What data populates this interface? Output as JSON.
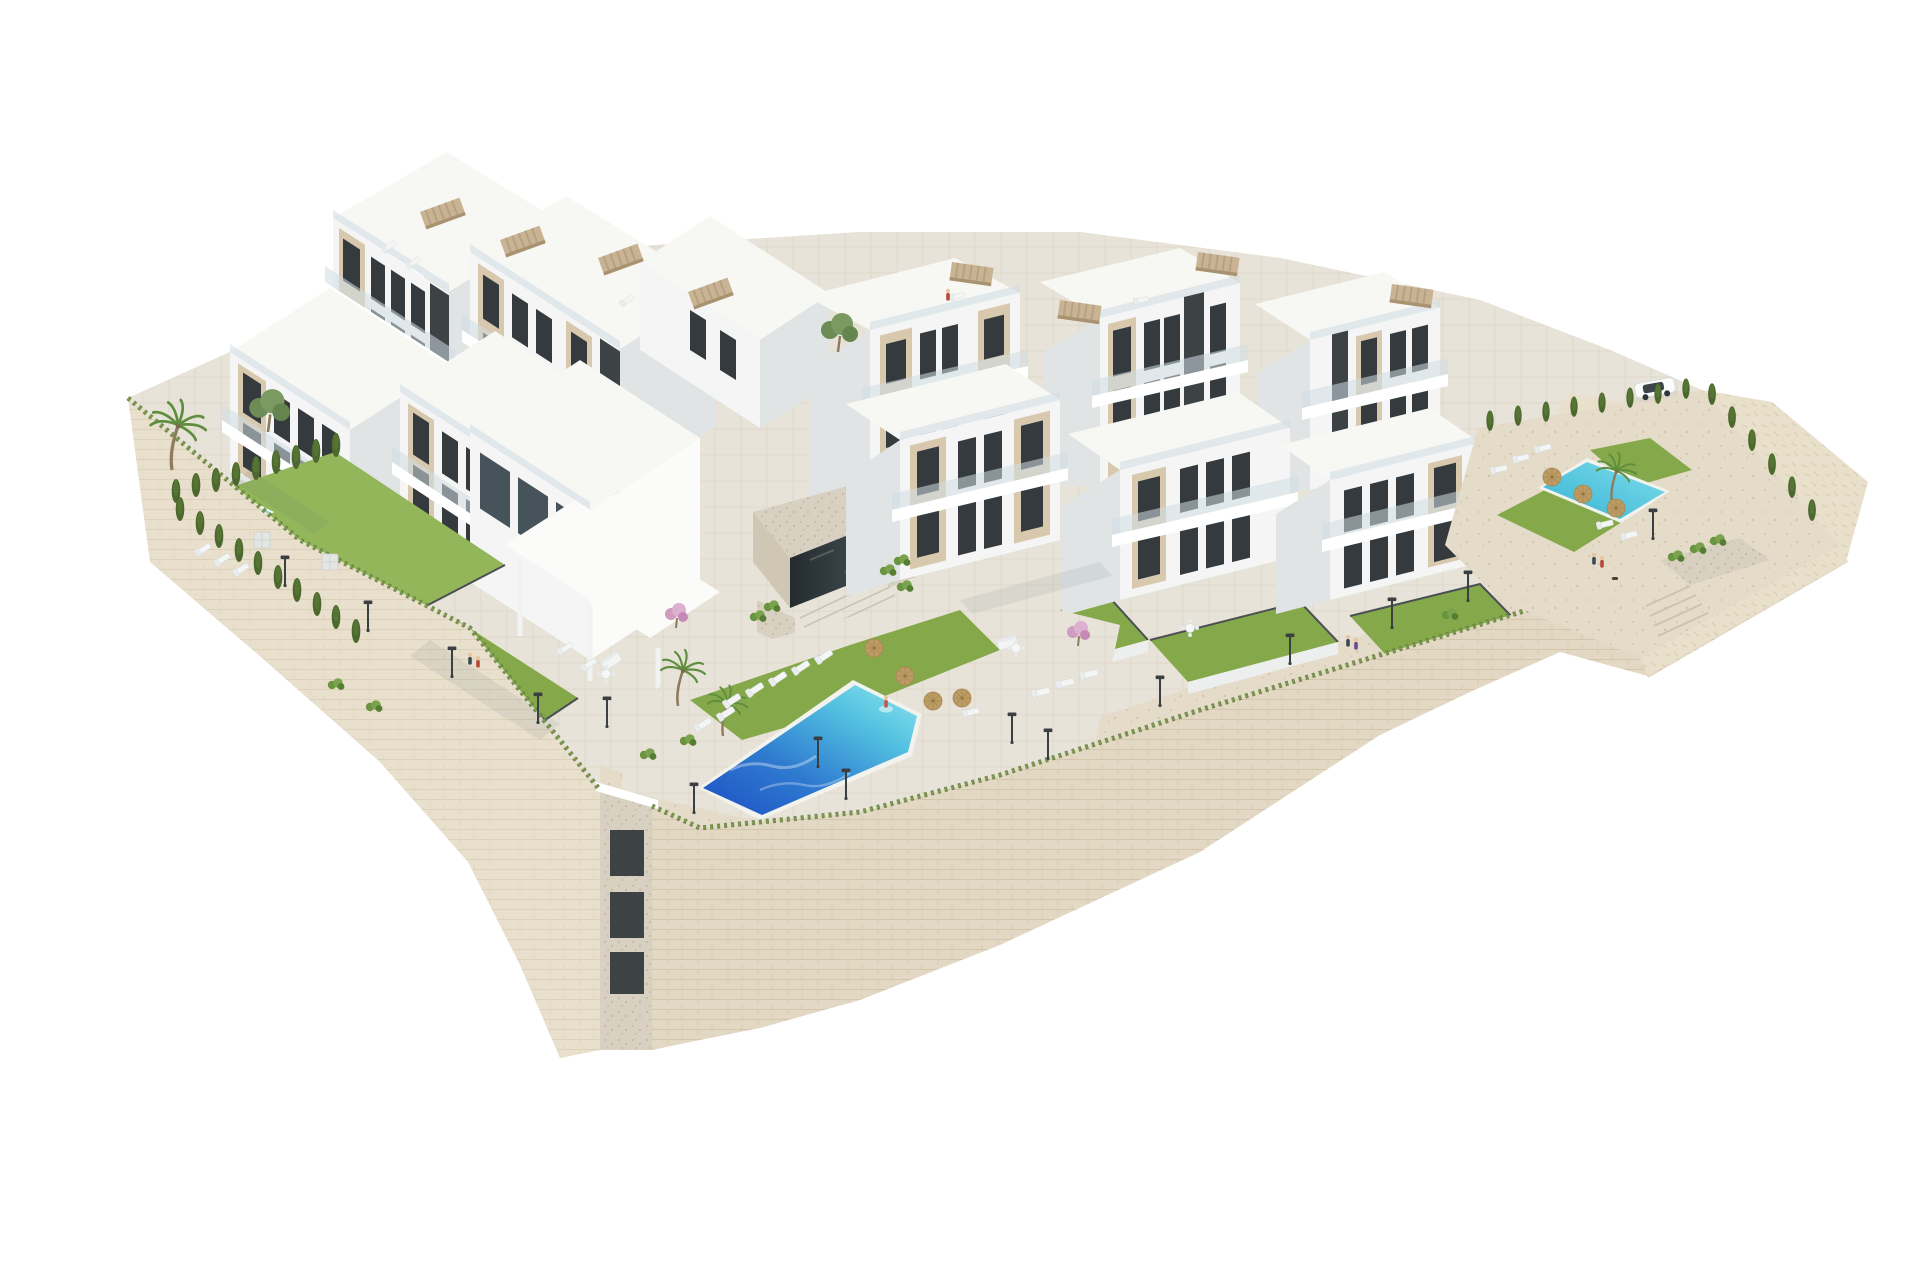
{
  "meta": {
    "title": "Aerial 3D architectural rendering of a hillside residential complex",
    "alt": "Photorealistic aerial render on a white background: terraced white and beige modern apartment blocks with rooftop pergolas and glass balconies, private lawned gardens, a large turquoise communal swimming pool with sun loungers and straw umbrellas, a smaller private pool on the left and another pool terrace with a parked white car on the right, all sitting on a curved sand-coloured stone retaining wall with street lamps, cypress hedges and palm trees."
  },
  "palette": {
    "background": "#ffffff",
    "facade_white": "#f4f5f4",
    "facade_bright": "#fbfbfa",
    "facade_side": "#e0e4e5",
    "facade_shade": "#ccd2d4",
    "roof_light": "#f7f7f3",
    "accent_beige": "#d8c9ae",
    "accent_beige_side": "#c2b093",
    "dark_tower": "#3d4245",
    "window_dark": "#343a3d",
    "glass_rail": "#cfdde3",
    "lawn": "#85a94a",
    "lawn_light": "#93b65a",
    "hedge": "#4c682e",
    "stone_wall": "#e2d8c3",
    "stone_joint": "#c9bb9e",
    "paving": "#e8e3d8",
    "paving_warm": "#e4dbc9",
    "pebble": "#d8d1c1",
    "rock": "#e9e0cc",
    "pool_deep": "#1e50c5",
    "pool_light": "#8ee6ef",
    "pool_small_a": "#35b2d4",
    "pool_small_b": "#7fdeea",
    "umbrella_straw": "#bb9c64",
    "lamp_dark": "#3a3f41",
    "fence": "#4a5053",
    "car_body": "#fafbfb",
    "trunk": "#8d7b5e",
    "palm_green": "#5f8f3e",
    "pink_tree": "#cf9cc0"
  },
  "scene": {
    "lamps": [
      [
        285,
        585
      ],
      [
        368,
        630
      ],
      [
        452,
        676
      ],
      [
        538,
        722
      ],
      [
        607,
        726
      ],
      [
        694,
        812
      ],
      [
        818,
        766
      ],
      [
        846,
        798
      ],
      [
        1012,
        742
      ],
      [
        1048,
        758
      ],
      [
        1160,
        705
      ],
      [
        1290,
        663
      ],
      [
        1392,
        627
      ],
      [
        1468,
        600
      ],
      [
        1653,
        538
      ]
    ],
    "cypresses": [
      [
        176,
        502
      ],
      [
        196,
        496
      ],
      [
        216,
        491
      ],
      [
        236,
        485
      ],
      [
        256,
        479
      ],
      [
        276,
        473
      ],
      [
        296,
        468
      ],
      [
        316,
        462
      ],
      [
        336,
        456
      ],
      [
        180,
        520
      ],
      [
        200,
        534
      ],
      [
        219,
        547
      ],
      [
        239,
        561
      ],
      [
        258,
        574
      ],
      [
        278,
        588
      ],
      [
        297,
        601
      ],
      [
        317,
        615
      ],
      [
        336,
        628
      ],
      [
        356,
        642
      ],
      [
        1490,
        430,
        0,
        0.85
      ],
      [
        1518,
        425,
        0,
        0.85
      ],
      [
        1546,
        421,
        0,
        0.85
      ],
      [
        1574,
        416,
        0,
        0.85
      ],
      [
        1602,
        412,
        0,
        0.85
      ],
      [
        1630,
        407,
        0,
        0.85
      ],
      [
        1658,
        403,
        0,
        0.85
      ],
      [
        1686,
        398,
        0,
        0.85
      ],
      [
        1712,
        404,
        0,
        0.9
      ],
      [
        1732,
        427,
        0,
        0.9
      ],
      [
        1752,
        450,
        0,
        0.9
      ],
      [
        1772,
        474,
        0,
        0.9
      ],
      [
        1792,
        497,
        0,
        0.9
      ],
      [
        1812,
        520,
        0,
        0.9
      ]
    ],
    "palms": [
      [
        172,
        470,
        0,
        1.25
      ],
      [
        678,
        706,
        0,
        1
      ],
      [
        723,
        736,
        0,
        0.9
      ],
      [
        1612,
        503,
        0,
        0.9
      ]
    ],
    "trees": [
      [
        268,
        432,
        0,
        1.1
      ],
      [
        838,
        352,
        0,
        1
      ]
    ],
    "pink_trees": [
      [
        676,
        628,
        0,
        1
      ],
      [
        1078,
        646,
        0,
        1
      ]
    ],
    "shrubs": [
      [
        758,
        620
      ],
      [
        772,
        610
      ],
      [
        888,
        574
      ],
      [
        902,
        564
      ],
      [
        688,
        744
      ],
      [
        648,
        758
      ],
      [
        1676,
        560
      ],
      [
        1698,
        552
      ],
      [
        1718,
        544
      ],
      [
        336,
        688
      ],
      [
        374,
        710
      ],
      [
        1450,
        618
      ],
      [
        905,
        590
      ]
    ],
    "loungers": [
      [
        733,
        700,
        -33
      ],
      [
        756,
        689,
        -33
      ],
      [
        779,
        678,
        -33
      ],
      [
        802,
        667,
        -33
      ],
      [
        825,
        656,
        -33
      ],
      [
        704,
        724,
        -33
      ],
      [
        727,
        713,
        -33
      ],
      [
        1042,
        692,
        -14
      ],
      [
        1066,
        683,
        -14
      ],
      [
        1090,
        674,
        -14
      ],
      [
        1500,
        469,
        -14,
        0.9
      ],
      [
        1522,
        458,
        -14,
        0.9
      ],
      [
        1544,
        448,
        -14,
        0.9
      ],
      [
        1606,
        524,
        -14,
        0.9
      ],
      [
        1630,
        535,
        -14,
        0.9
      ],
      [
        204,
        549,
        -33,
        0.9
      ],
      [
        223,
        559,
        -33,
        0.9
      ],
      [
        242,
        569,
        -33,
        0.9
      ],
      [
        390,
        246,
        -33,
        0.8
      ],
      [
        414,
        262,
        -33,
        0.8
      ],
      [
        628,
        300,
        -33,
        0.8
      ],
      [
        958,
        296,
        -14,
        0.8
      ],
      [
        1142,
        300,
        -14,
        0.8
      ],
      [
        566,
        648,
        -33,
        0.9
      ],
      [
        590,
        664,
        -33,
        0.9
      ],
      [
        972,
        712,
        -14,
        0.9
      ]
    ],
    "sofas": [
      [
        1008,
        644,
        -14
      ],
      [
        612,
        662,
        -33
      ]
    ],
    "tables": [
      [
        606,
        674
      ],
      [
        1016,
        648
      ],
      [
        1190,
        628
      ]
    ],
    "umbrellas": [
      [
        874,
        648
      ],
      [
        905,
        676
      ],
      [
        933,
        701
      ],
      [
        962,
        698
      ],
      [
        1552,
        477
      ],
      [
        1583,
        494
      ],
      [
        1616,
        508
      ]
    ],
    "umbrellas_gray": [
      [
        330,
        562
      ],
      [
        262,
        540
      ]
    ],
    "pergolas": [
      [
        420,
        212,
        -20
      ],
      [
        500,
        240,
        -20
      ],
      [
        598,
        258,
        -20
      ],
      [
        688,
        292,
        -20
      ],
      [
        952,
        262,
        8
      ],
      [
        1198,
        252,
        8
      ],
      [
        1392,
        284,
        8
      ],
      [
        1060,
        300,
        8
      ]
    ],
    "people": [
      [
        470,
        664,
        "#3b4a52"
      ],
      [
        478,
        667,
        "#b5493a"
      ],
      [
        1348,
        646,
        "#3b4a52"
      ],
      [
        1356,
        649,
        "#6b4a8f"
      ],
      [
        1594,
        564,
        "#3b4a52"
      ],
      [
        1602,
        567,
        "#b5493a"
      ],
      [
        948,
        300,
        "#b5493a"
      ],
      [
        886,
        707,
        "#c4574a"
      ]
    ],
    "dogs": [
      [
        1612,
        577
      ]
    ]
  }
}
